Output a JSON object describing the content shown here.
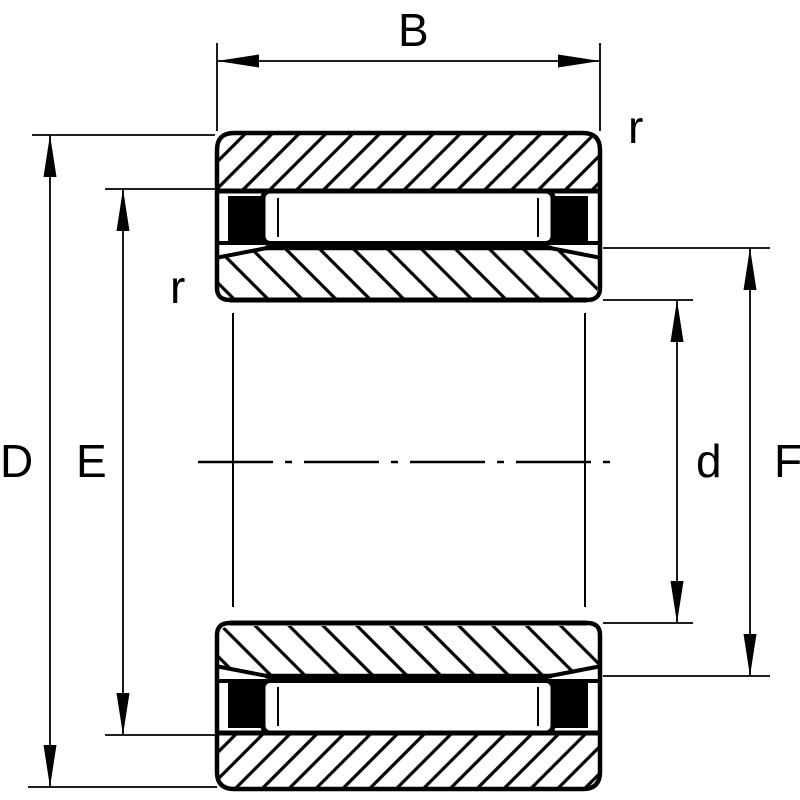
{
  "drawing": {
    "description": "needle roller bearing cross-section",
    "colors": {
      "line": "#000000",
      "background": "#ffffff",
      "seal_fill": "#000000"
    },
    "dimension_labels": {
      "width_b": "B",
      "outer_diameter_d": "D",
      "outer_raceway_e": "E",
      "bore_d": "d",
      "inner_raceway_f": "F",
      "fillet_left_r": "r",
      "fillet_right_r": "r"
    }
  }
}
